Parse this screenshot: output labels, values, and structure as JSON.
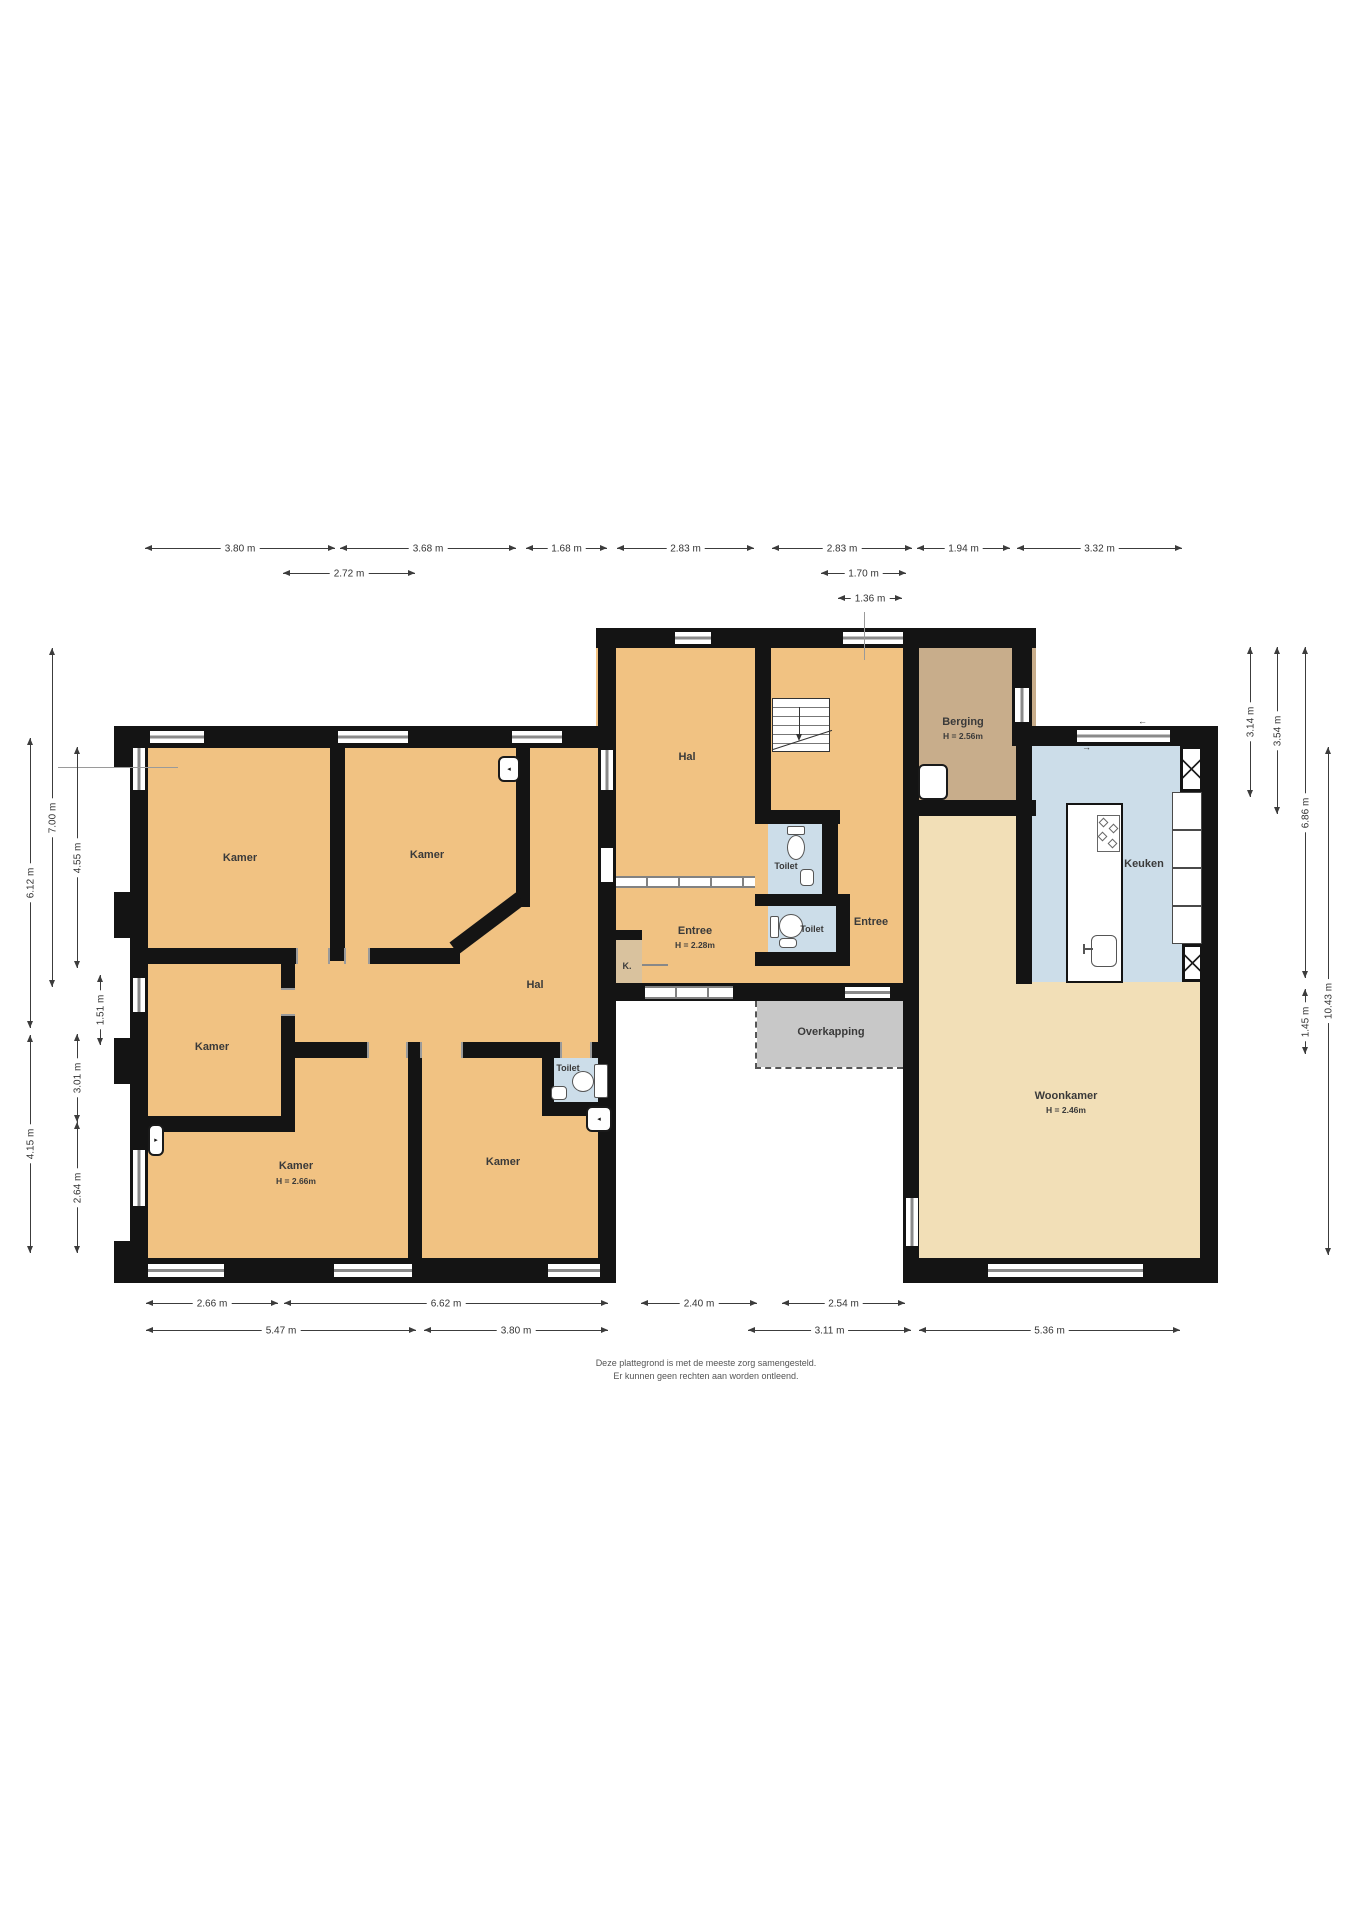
{
  "rooms": {
    "kamer1": {
      "name": "Kamer"
    },
    "kamer2": {
      "name": "Kamer"
    },
    "kamer3": {
      "name": "Kamer"
    },
    "kamer4": {
      "name": "Kamer",
      "height": "H = 2.66m"
    },
    "kamer5": {
      "name": "Kamer"
    },
    "hal_west": {
      "name": "Hal"
    },
    "hal_noord": {
      "name": "Hal"
    },
    "toilet_west": {
      "name": "Toilet"
    },
    "toilet_noord": {
      "name": "Toilet"
    },
    "toilet_midden": {
      "name": "Toilet"
    },
    "entree_west": {
      "name": "Entree",
      "height": "H = 2.28m"
    },
    "entree_oost": {
      "name": "Entree"
    },
    "kast": {
      "name": "K."
    },
    "berging": {
      "name": "Berging",
      "height": "H = 2.56m"
    },
    "keuken": {
      "name": "Keuken"
    },
    "woonkamer": {
      "name": "Woonkamer",
      "height": "H = 2.46m"
    },
    "overkapping": {
      "name": "Overkapping"
    }
  },
  "dims": {
    "t1": {
      "label": "3.80 m"
    },
    "t2": {
      "label": "3.68 m"
    },
    "t3": {
      "label": "1.68 m"
    },
    "t4": {
      "label": "2.83 m"
    },
    "t5": {
      "label": "2.83 m"
    },
    "t6": {
      "label": "1.94 m"
    },
    "t7": {
      "label": "3.32 m"
    },
    "t8": {
      "label": "2.72 m"
    },
    "t9": {
      "label": "1.70 m"
    },
    "t10": {
      "label": "1.36 m"
    },
    "b1": {
      "label": "2.66 m"
    },
    "b2": {
      "label": "6.62 m"
    },
    "b3": {
      "label": "2.40 m"
    },
    "b4": {
      "label": "2.54 m"
    },
    "b5": {
      "label": "5.47 m"
    },
    "b6": {
      "label": "3.80 m"
    },
    "b7": {
      "label": "3.11 m"
    },
    "b8": {
      "label": "5.36 m"
    },
    "l1": {
      "label": "6.12 m"
    },
    "l2": {
      "label": "7.00 m"
    },
    "l3": {
      "label": "4.55 m"
    },
    "l4": {
      "label": "1.51 m"
    },
    "l5": {
      "label": "3.01 m"
    },
    "l6": {
      "label": "2.64 m"
    },
    "l7": {
      "label": "4.15 m"
    },
    "r1": {
      "label": "3.14 m"
    },
    "r2": {
      "label": "3.54 m"
    },
    "r3": {
      "label": "6.86 m"
    },
    "r4": {
      "label": "1.45 m"
    },
    "r5": {
      "label": "10.43 m"
    }
  },
  "disclaimer": {
    "line1": "Deze plattegrond is met de meeste zorg samengesteld.",
    "line2": "Er kunnen geen rechten aan worden ontleend."
  },
  "colors": {
    "room_orange": "#F1C282",
    "living_beige": "#F2DFB7",
    "kitchen_blue": "#CCDDE9",
    "toilet_blue": "#CCDDE9",
    "storage_brown": "#C8AD8B",
    "closet_tan": "#D9C29E",
    "canopy_grey": "#C8C8C8",
    "wall_black": "#141414"
  }
}
